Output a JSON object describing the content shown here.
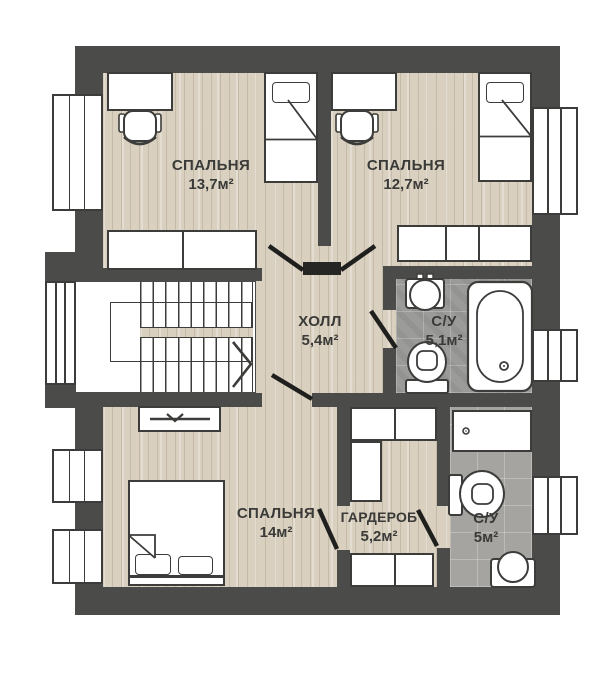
{
  "rooms": [
    {
      "id": "bedroom-1",
      "name": "СПАЛЬНЯ",
      "area": "13,7м²"
    },
    {
      "id": "bedroom-2",
      "name": "СПАЛЬНЯ",
      "area": "12,7м²"
    },
    {
      "id": "hall",
      "name": "ХОЛЛ",
      "area": "5,4м²"
    },
    {
      "id": "bathroom-1",
      "name": "С/У",
      "area": "5,1м²"
    },
    {
      "id": "bedroom-3",
      "name": "СПАЛЬНЯ",
      "area": "14м²"
    },
    {
      "id": "wardrobe",
      "name": "ГАРДЕРОБ",
      "area": "5,2м²"
    },
    {
      "id": "bathroom-2",
      "name": "С/У",
      "area": "5м²"
    }
  ],
  "fixtures": [
    "single-bed",
    "double-bed",
    "desk",
    "office-chair",
    "dresser",
    "wardrobe-cabinet",
    "tv",
    "toilet",
    "sink",
    "bathtub",
    "shower-tray",
    "stairs",
    "window",
    "door-leaf"
  ],
  "colors": {
    "wall": "#4b4b49",
    "wood_floor": "#d9d0bf",
    "tile_dark": "#9b9b99",
    "tile_light": "#a6a4a0",
    "line": "#3c3c3a",
    "door": "#1f1f1d",
    "background": "#ffffff"
  }
}
